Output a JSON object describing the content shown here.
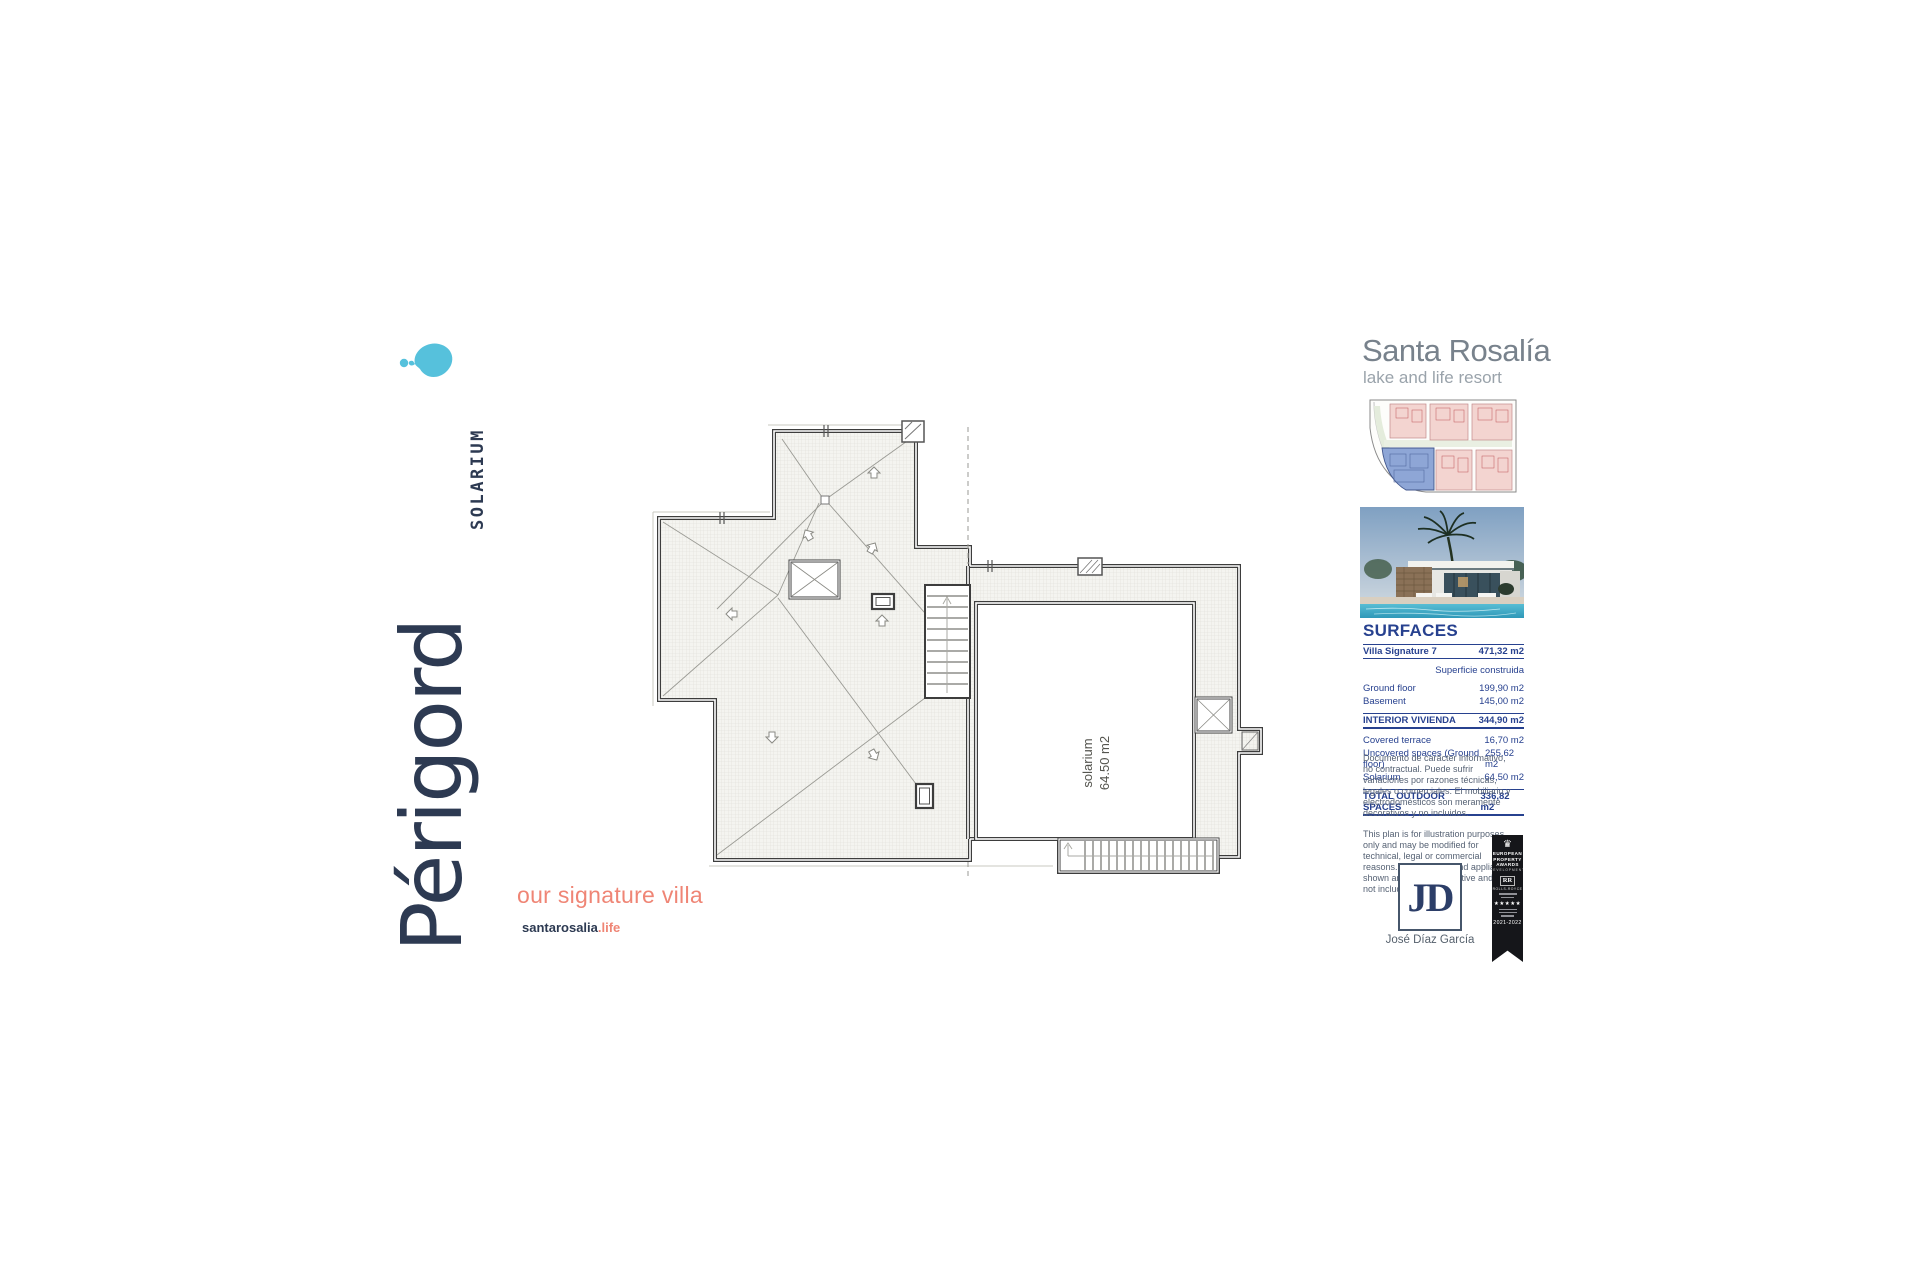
{
  "branding": {
    "villa_name": "Périgord",
    "plan_label": "SOLARIUM",
    "tagline": "our signature villa",
    "website_base": "santarosalia",
    "website_tld": ".life",
    "logo_color": "#56c1dc"
  },
  "resort": {
    "name": "Santa Rosalía",
    "subtitle": "lake and life resort"
  },
  "plan": {
    "room_label": "solarium",
    "room_area": "64.50 m2"
  },
  "surfaces": {
    "title": "SURFACES",
    "header_row": {
      "label": "Villa Signature 7",
      "value": "471,32 m2"
    },
    "subheader": "Superficie construida",
    "rows": [
      {
        "label": "Ground floor",
        "value": "199,90 m2"
      },
      {
        "label": "Basement",
        "value": "145,00 m2"
      }
    ],
    "interior_row": {
      "label": "INTERIOR VIVIENDA",
      "value": "344,90 m2"
    },
    "outdoor_rows": [
      {
        "label": "Covered terrace",
        "value": "16,70 m2"
      },
      {
        "label": "Uncovered spaces (Ground floor)",
        "value": "255,62 m2"
      },
      {
        "label": "Solarium",
        "value": "64,50 m2"
      }
    ],
    "total_row": {
      "label": "TOTAL OUTDOOR SPACES",
      "value": "336,82 m2"
    }
  },
  "disclaimer": {
    "es": "Documento de carácter informativo, no contractual. Puede sufrir variaciones por razones técnicas, legales o comerciales. El mobiliario y electrodomésticos son meramente decorativos y no incluidos.",
    "en": "This plan is for illustration purposes only and may be modified for technical, legal or commercial reasons. The furniture and appliances shown are purely decorative and are not included."
  },
  "architect": {
    "initials": "JD",
    "name": "José Díaz García"
  },
  "award": {
    "crest_icon": "♛",
    "org_line1": "EUROPEAN",
    "org_line2": "PROPERTY",
    "org_line3": "AWARDS",
    "category": "DEVELOPMENT",
    "sponsor_monogram": "RR",
    "sponsor": "ROLLS-ROYCE",
    "stars": "★★★★★",
    "years": "2021-2022"
  }
}
